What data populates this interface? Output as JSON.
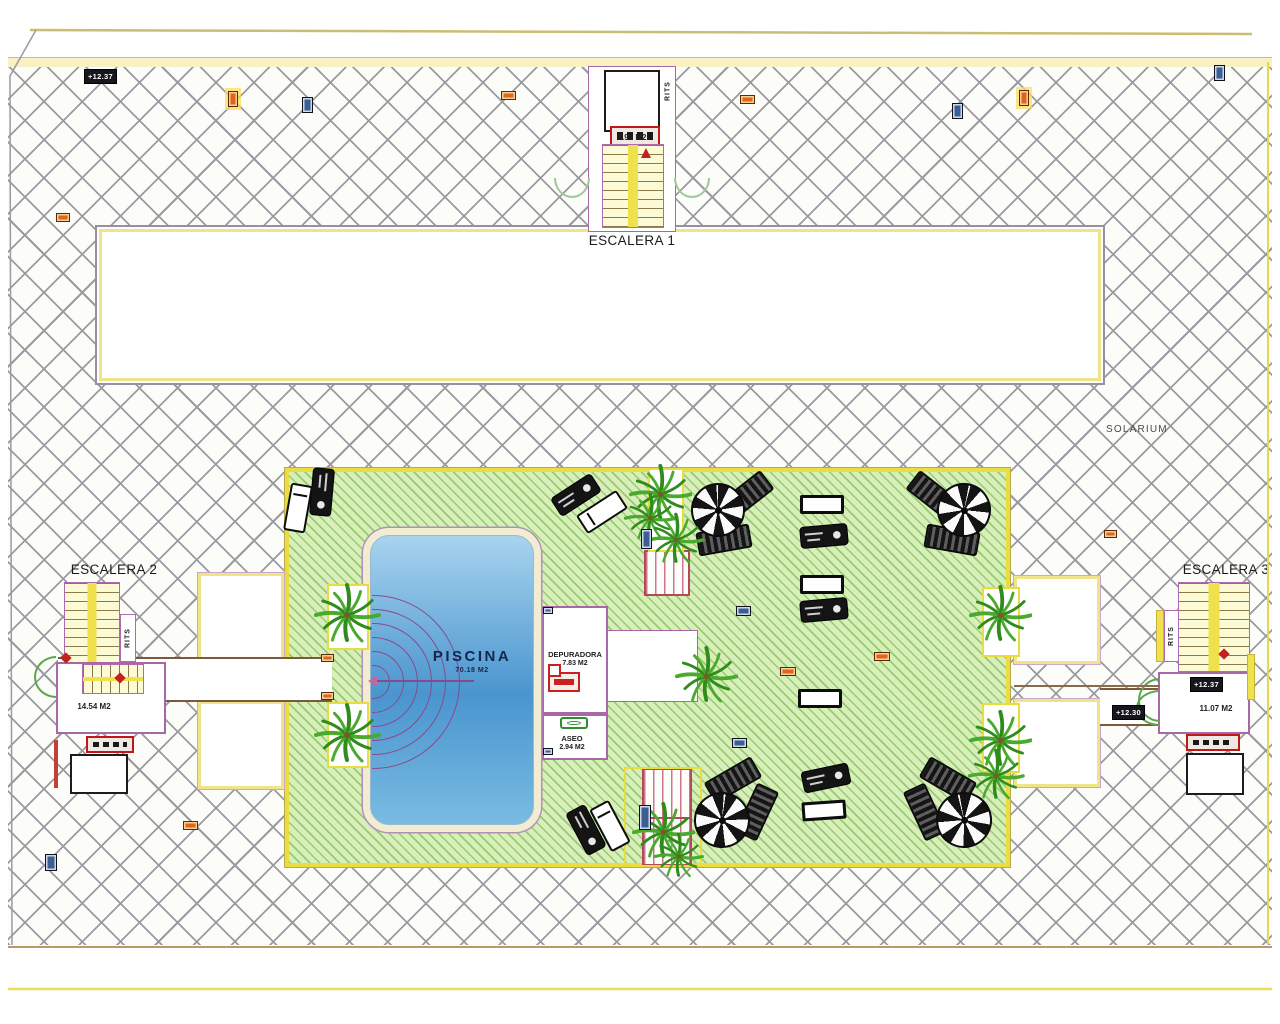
{
  "labels": {
    "escalera1": {
      "title": "ESCALERA 1",
      "area": "8.91 M2"
    },
    "escalera2": {
      "title": "ESCALERA 2",
      "area": "14.54 M2"
    },
    "escalera3": {
      "title": "ESCALERA 3",
      "area": "11.07 M2",
      "level_badge": "+12.37"
    },
    "rits": "RITS",
    "solarium": "SOLARIUM",
    "pool": {
      "name": "PISCINA",
      "area": "70.18 M2"
    },
    "depuradora": {
      "name": "DEPURADORA",
      "area": "7.83 M2"
    },
    "aseo": {
      "name": "ASEO",
      "area": "2.94 M2"
    },
    "levels": {
      "top_left": "+12.37",
      "right": "+12.30"
    }
  },
  "colors": {
    "hatch_line": "#9a9aa2",
    "green_deck": "#d9eebb",
    "yellow_border": "#e9dd42",
    "wall_purple": "#a868a8",
    "pool_blue": "#4a95cf",
    "red_symbol": "#c42020"
  },
  "scene": {
    "planters": [
      [
        327,
        584,
        42,
        66,
        0
      ],
      [
        327,
        702,
        42,
        66,
        0
      ],
      [
        982,
        587,
        38,
        70,
        0
      ],
      [
        982,
        703,
        38,
        70,
        0
      ],
      [
        648,
        468,
        36,
        84,
        0
      ],
      [
        624,
        767,
        78,
        100,
        1
      ]
    ],
    "umbrellas": [
      [
        718,
        510,
        54,
        0
      ],
      [
        964,
        510,
        54,
        15
      ],
      [
        722,
        820,
        56,
        8
      ],
      [
        964,
        820,
        56,
        -10
      ]
    ],
    "loungers_striped": [
      [
        746,
        496,
        -38
      ],
      [
        724,
        540,
        -10
      ],
      [
        934,
        496,
        38
      ],
      [
        952,
        540,
        10
      ],
      [
        733,
        780,
        -30
      ],
      [
        757,
        812,
        -65
      ],
      [
        948,
        780,
        30
      ],
      [
        925,
        812,
        65
      ]
    ],
    "loungers_person": [
      [
        322,
        492,
        95
      ],
      [
        576,
        495,
        -33
      ],
      [
        824,
        536,
        -5
      ],
      [
        824,
        610,
        -5
      ],
      [
        826,
        778,
        -12
      ],
      [
        586,
        830,
        62
      ]
    ],
    "loungers_white": [
      [
        298,
        508,
        100
      ],
      [
        602,
        512,
        -33
      ],
      [
        610,
        826,
        62
      ]
    ],
    "tables": [
      [
        822,
        504,
        0
      ],
      [
        822,
        584,
        0
      ],
      [
        820,
        698,
        0
      ],
      [
        824,
        810,
        -4
      ]
    ],
    "palms": [
      [
        347,
        615,
        1
      ],
      [
        347,
        735,
        1
      ],
      [
        660,
        494,
        0.95
      ],
      [
        650,
        518,
        0.8
      ],
      [
        676,
        540,
        0.85
      ],
      [
        706,
        676,
        0.95
      ],
      [
        1000,
        615,
        0.95
      ],
      [
        1000,
        740,
        0.95
      ],
      [
        663,
        832,
        0.95
      ],
      [
        678,
        856,
        0.75
      ],
      [
        996,
        776,
        0.85
      ]
    ],
    "markers": [
      [
        "blue",
        302,
        97,
        11,
        16
      ],
      [
        "blue",
        952,
        103,
        11,
        16
      ],
      [
        "blue",
        1214,
        65,
        11,
        16
      ],
      [
        "blue",
        45,
        854,
        12,
        17
      ],
      [
        "blue",
        641,
        529,
        11,
        20
      ],
      [
        "blue",
        736,
        606,
        15,
        10
      ],
      [
        "blue",
        732,
        738,
        15,
        10
      ],
      [
        "blue",
        639,
        805,
        12,
        25
      ],
      [
        "blue",
        543,
        607,
        10,
        7
      ],
      [
        "blue",
        543,
        748,
        10,
        7
      ],
      [
        "orange",
        501,
        91,
        15,
        9
      ],
      [
        "orange",
        740,
        95,
        15,
        9
      ],
      [
        "orange",
        56,
        213,
        14,
        9
      ],
      [
        "orange",
        183,
        821,
        15,
        9
      ],
      [
        "orange",
        1104,
        530,
        13,
        8
      ],
      [
        "orange",
        321,
        654,
        13,
        8
      ],
      [
        "orange",
        321,
        692,
        13,
        8
      ],
      [
        "orange",
        780,
        667,
        16,
        9
      ],
      [
        "orange",
        874,
        652,
        16,
        9
      ],
      [
        "orange glow",
        228,
        91,
        10,
        16
      ],
      [
        "orange glow",
        1019,
        90,
        10,
        16
      ]
    ],
    "badges": [
      [
        84,
        69,
        "labels.levels.top_left"
      ],
      [
        1190,
        677,
        "labels.escalera3.level_badge"
      ],
      [
        1112,
        705,
        "labels.levels.right"
      ]
    ]
  }
}
